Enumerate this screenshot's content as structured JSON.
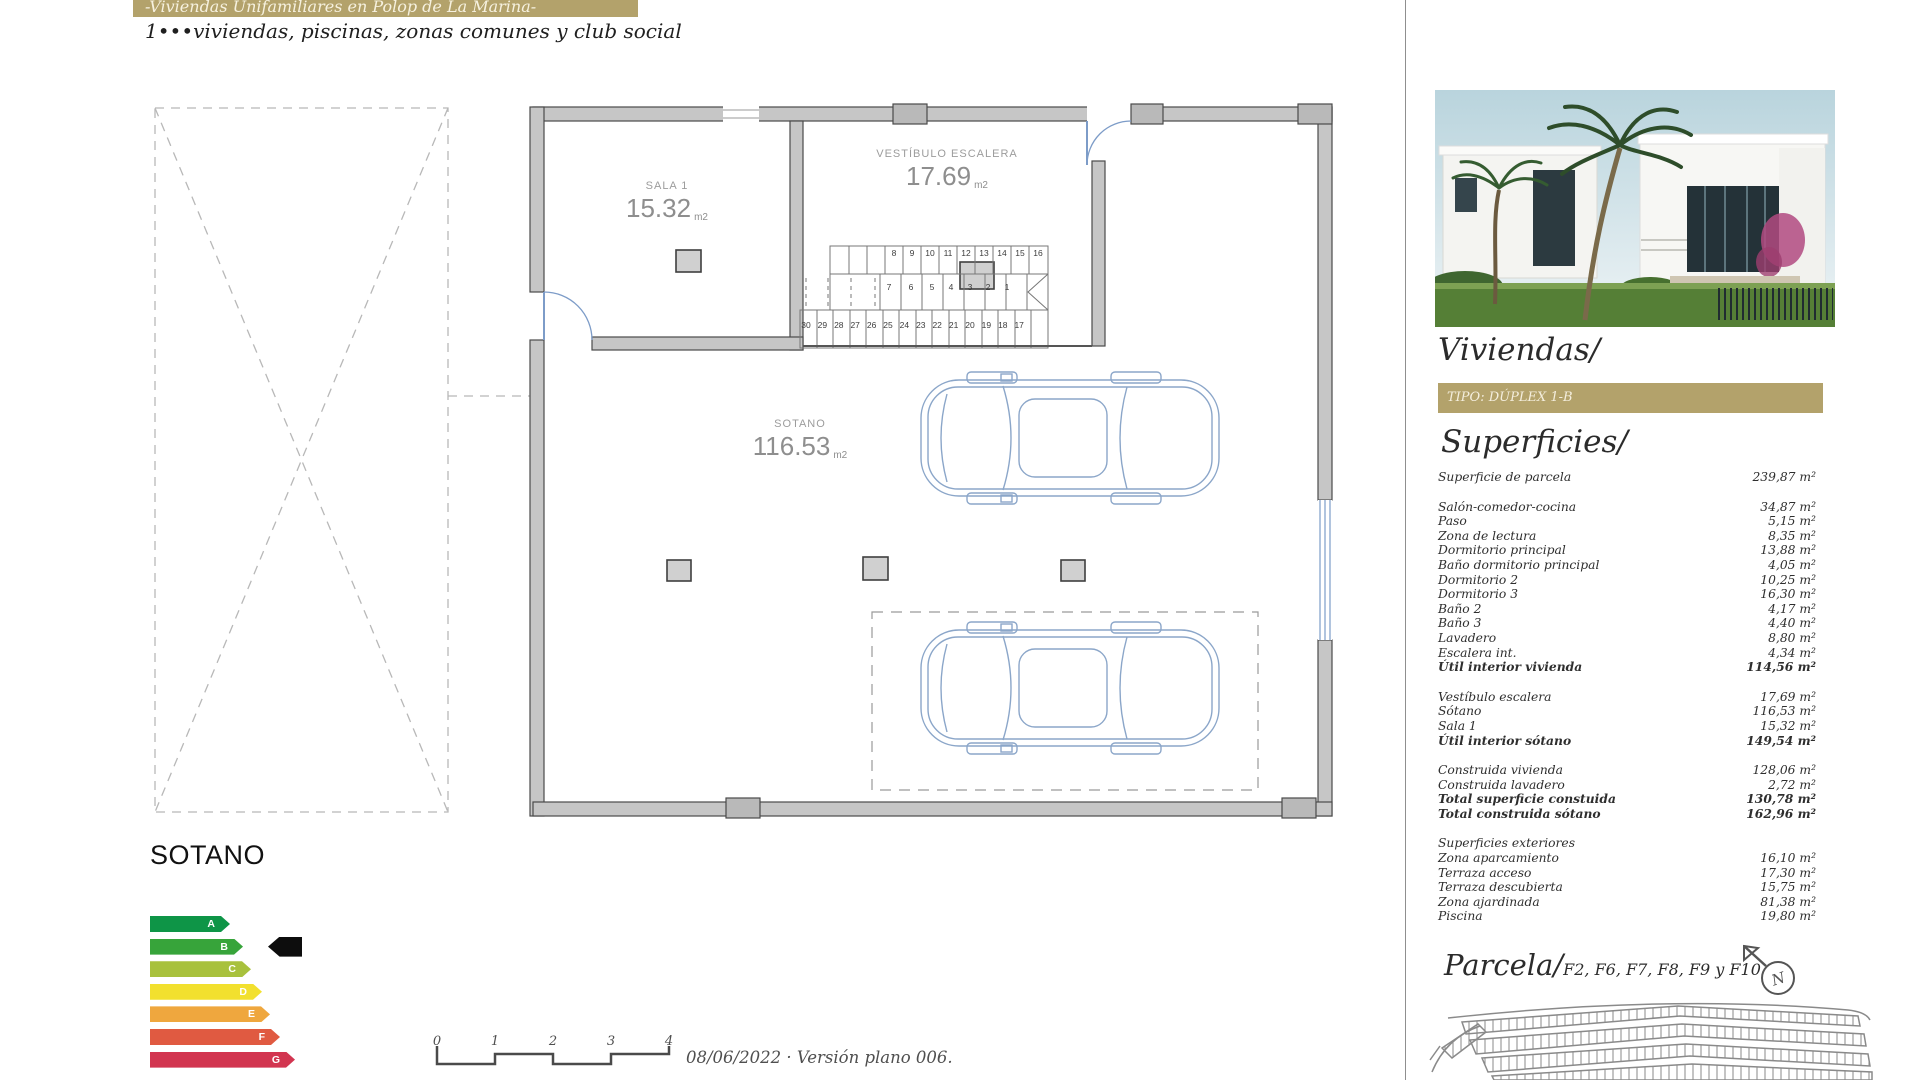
{
  "header": {
    "banner_title": "-Viviendas Unifamiliares en Polop de La Marina-",
    "subtitle": "1•••viviendas, piscinas, zonas comunes y club social"
  },
  "plan": {
    "floor_label": "SOTANO",
    "rooms": [
      {
        "name": "SALA 1",
        "area": "15.32",
        "unit": "m2"
      },
      {
        "name": "VESTÍBULO ESCALERA",
        "area": "17.69",
        "unit": "m2"
      },
      {
        "name": "SOTANO",
        "area": "116.53",
        "unit": "m2"
      }
    ],
    "stairs": {
      "top": [
        "8",
        "9",
        "10",
        "11",
        "12",
        "13",
        "14",
        "15",
        "16"
      ],
      "mid": [
        "7",
        "6",
        "5",
        "4",
        "3",
        "2",
        "1"
      ],
      "bottom": [
        "30",
        "29",
        "28",
        "27",
        "26",
        "25",
        "24",
        "23",
        "22",
        "21",
        "20",
        "19",
        "18",
        "17"
      ]
    }
  },
  "energy": {
    "selected": "B",
    "levels": [
      {
        "letter": "A",
        "color": "#0e9547"
      },
      {
        "letter": "B",
        "color": "#37a43a"
      },
      {
        "letter": "C",
        "color": "#a8c13d"
      },
      {
        "letter": "D",
        "color": "#f2e02e"
      },
      {
        "letter": "E",
        "color": "#efa73e"
      },
      {
        "letter": "F",
        "color": "#e05a41"
      },
      {
        "letter": "G",
        "color": "#d23550"
      }
    ]
  },
  "footer": {
    "scale_ticks": [
      "0",
      "1",
      "2",
      "3",
      "4"
    ],
    "version_text": "08/06/2022 · Versión plano 006."
  },
  "sidebar": {
    "viviendas_heading": "Viviendas/",
    "tipo_banner": "TIPO: DÚPLEX 1-B",
    "superficies_heading": "Superficies/",
    "superficies_groups": [
      {
        "rows": [
          {
            "label": "Superficie de parcela",
            "value": "239,87 m²",
            "bold": false
          }
        ]
      },
      {
        "rows": [
          {
            "label": "Salón-comedor-cocina",
            "value": "34,87 m²",
            "bold": false
          },
          {
            "label": "Paso",
            "value": "5,15 m²",
            "bold": false
          },
          {
            "label": "Zona de lectura",
            "value": "8,35 m²",
            "bold": false
          },
          {
            "label": "Dormitorio principal",
            "value": "13,88 m²",
            "bold": false
          },
          {
            "label": "Baño dormitorio principal",
            "value": "4,05 m²",
            "bold": false
          },
          {
            "label": "Dormitorio 2",
            "value": "10,25 m²",
            "bold": false
          },
          {
            "label": "Dormitorio 3",
            "value": "16,30 m²",
            "bold": false
          },
          {
            "label": "Baño 2",
            "value": "4,17 m²",
            "bold": false
          },
          {
            "label": "Baño 3",
            "value": "4,40 m²",
            "bold": false
          },
          {
            "label": "Lavadero",
            "value": "8,80 m²",
            "bold": false
          },
          {
            "label": "Escalera int.",
            "value": "4,34 m²",
            "bold": false
          },
          {
            "label": "Útil interior vivienda",
            "value": "114,56 m²",
            "bold": true
          }
        ]
      },
      {
        "rows": [
          {
            "label": "Vestíbulo escalera",
            "value": "17,69 m²",
            "bold": false
          },
          {
            "label": "Sótano",
            "value": "116,53 m²",
            "bold": false
          },
          {
            "label": "Sala 1",
            "value": "15,32 m²",
            "bold": false
          },
          {
            "label": "Útil interior sótano",
            "value": "149,54 m²",
            "bold": true
          }
        ]
      },
      {
        "rows": [
          {
            "label": "Construida vivienda",
            "value": "128,06 m²",
            "bold": false
          },
          {
            "label": "Construida lavadero",
            "value": "2,72 m²",
            "bold": false
          },
          {
            "label": "Total superficie constuida",
            "value": "130,78 m²",
            "bold": true
          },
          {
            "label": "Total construida sótano",
            "value": "162,96 m²",
            "bold": true
          }
        ]
      },
      {
        "rows": [
          {
            "label": "Superficies exteriores",
            "value": "",
            "bold": false
          },
          {
            "label": "Zona aparcamiento",
            "value": "16,10 m²",
            "bold": false
          },
          {
            "label": "Terraza acceso",
            "value": "17,30 m²",
            "bold": false
          },
          {
            "label": "Terraza descubierta",
            "value": "15,75 m²",
            "bold": false
          },
          {
            "label": "Zona ajardinada",
            "value": "81,38 m²",
            "bold": false
          },
          {
            "label": "Piscina",
            "value": "19,80 m²",
            "bold": false
          }
        ]
      }
    ],
    "parcela_heading": "Parcela/",
    "parcela_codes": "F2, F6, F7, F8, F9 y F10",
    "compass_letter": "N"
  },
  "colors": {
    "gold": "#b3a26b",
    "blueprint": "#7d9cc8",
    "wall": "#c6c6c6"
  }
}
